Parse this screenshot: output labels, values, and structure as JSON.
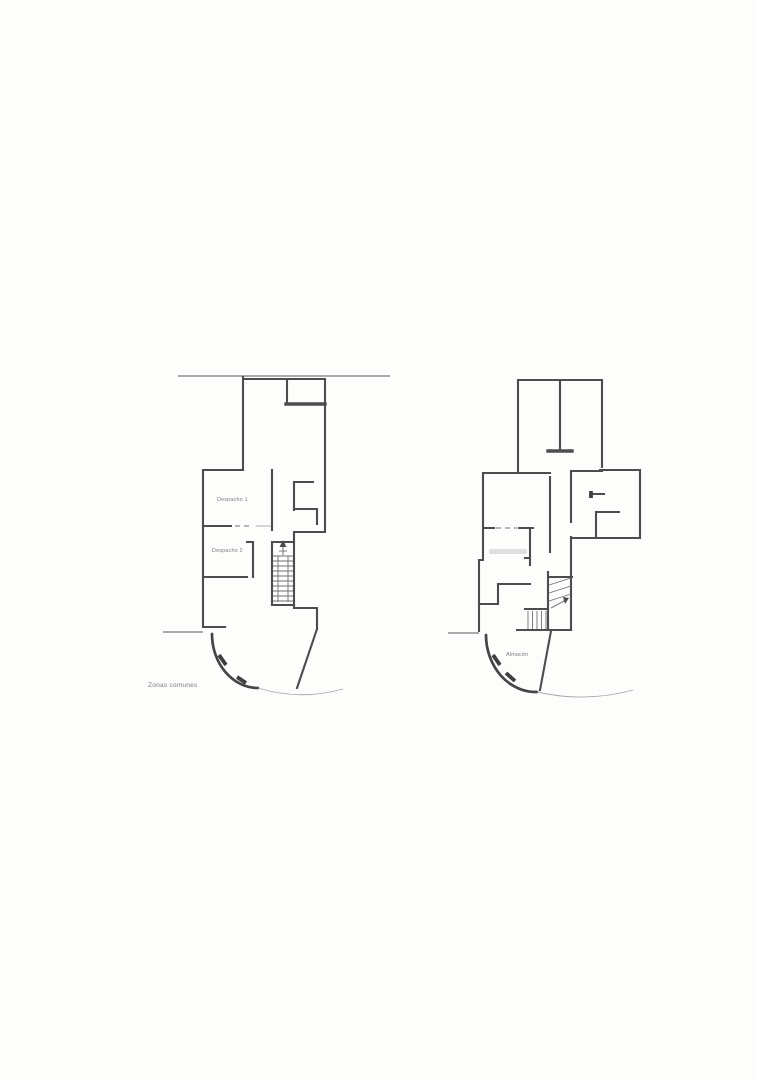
{
  "colors": {
    "wall": "#4d4d4d",
    "thin_line": "#8f8f8f",
    "tread": "#707070",
    "faint": "#a8a8a8",
    "label_text": "#7b7b7b",
    "paper": "#fdfdfc"
  },
  "left_plan": {
    "labels": {
      "room1": "Despacho 1",
      "room2": "Despacho 2",
      "zones": "Zonas comunes"
    }
  },
  "right_plan": {
    "labels": {
      "storage": "Almacén"
    }
  }
}
